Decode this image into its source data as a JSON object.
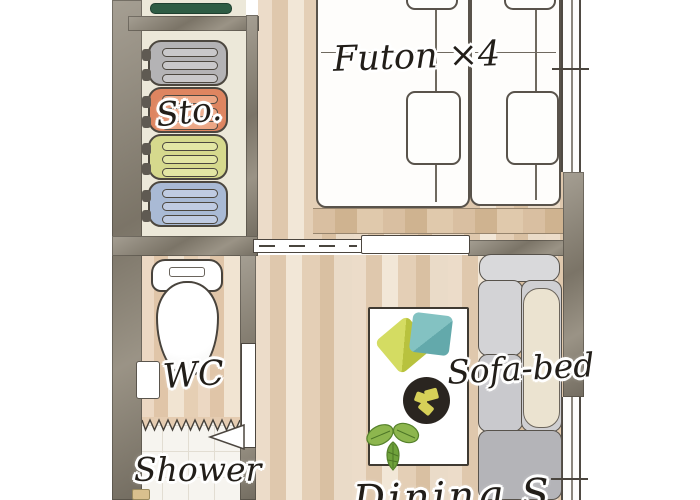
{
  "scene": {
    "type": "apartment floor plan illustration",
    "style": "hand-drawn watercolor"
  },
  "labels": {
    "futon": "Futon ×4",
    "storage": "Sto.",
    "wc": "WC",
    "shower": "Shower",
    "sofa_bed": "Sofa-bed",
    "dining": "Dining S"
  },
  "storage": {
    "suitcases": [
      {
        "name": "suitcase-gray",
        "body": "#b4b3b5",
        "ridge": "#c9c8ca"
      },
      {
        "name": "suitcase-orange",
        "body": "#de8560",
        "ridge": "#eca684"
      },
      {
        "name": "suitcase-green",
        "body": "#d6d98d",
        "ridge": "#e3e6a4"
      },
      {
        "name": "suitcase-blue",
        "body": "#a9bad5",
        "ridge": "#bfcbe2"
      }
    ]
  },
  "colors": {
    "wall": "#8f8778",
    "wood_floor": "#e6d2bb",
    "wc_wood_floor": "#e9d4bd",
    "tile_floor": "#f6f4ef",
    "storage_floor": "#ece8d9",
    "futon": "#fefdfb",
    "sofa_gray": "#c9c9cd",
    "sofa_pillow": "#ebe3d0",
    "cushion_green": "#c9d250",
    "cushion_teal": "#74b9ba",
    "plate": "#2a2520",
    "plant_green": "#7fae3f",
    "shelf_green": "#2e5c44",
    "outline": "#4c463f"
  }
}
